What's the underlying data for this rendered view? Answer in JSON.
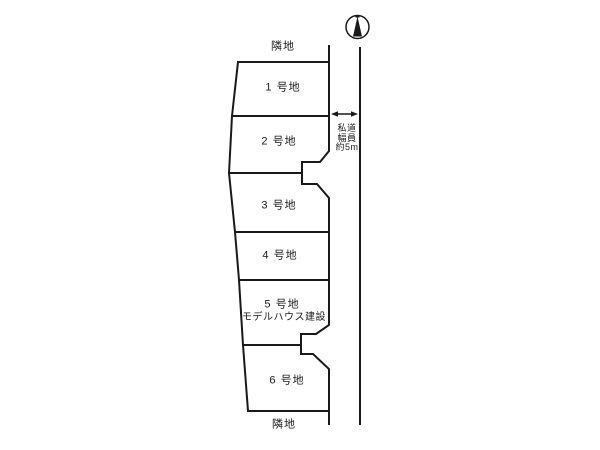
{
  "page": {
    "background_color": "#ffffff",
    "line_color": "#1a1a1a"
  },
  "adjacent_land": {
    "top_label": "隣地",
    "bottom_label": "隣地"
  },
  "lots": [
    {
      "label": "1 号地"
    },
    {
      "label": "2 号地"
    },
    {
      "label": "3 号地"
    },
    {
      "label": "4 号地"
    },
    {
      "label": "5 号地",
      "note": "モデルハウス建設"
    },
    {
      "label": "6 号地"
    }
  ],
  "road": {
    "label_lines": [
      "私道",
      "幅員",
      "約5m"
    ]
  },
  "icons": {
    "compass": "north-compass"
  }
}
